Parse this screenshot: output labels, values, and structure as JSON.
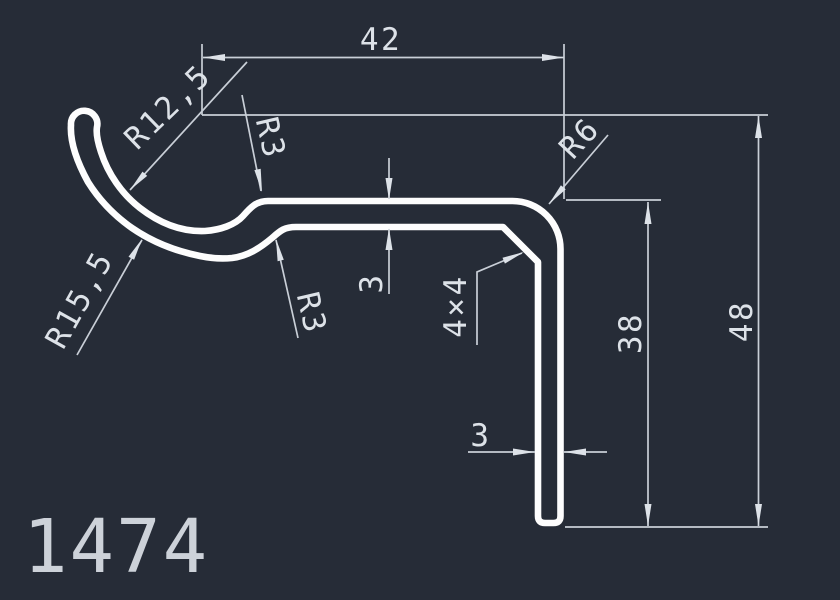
{
  "drawing": {
    "profile_number": "1474",
    "dimensions": {
      "overall_width": "42",
      "overall_height": "48",
      "leg_height": "38",
      "arm_thickness": "3",
      "leg_thickness": "3",
      "chamfer": "4×4",
      "hook_inner_radius": "R12,5",
      "hook_outer_radius": "R15,5",
      "fillet_top": "R3",
      "fillet_bottom": "R3",
      "corner_radius": "R6"
    },
    "colors": {
      "background": "#262c37",
      "profile_line": "#fdfdfd",
      "dimension_line": "#c9cfd7",
      "dimension_text": "#dde2e8"
    }
  }
}
